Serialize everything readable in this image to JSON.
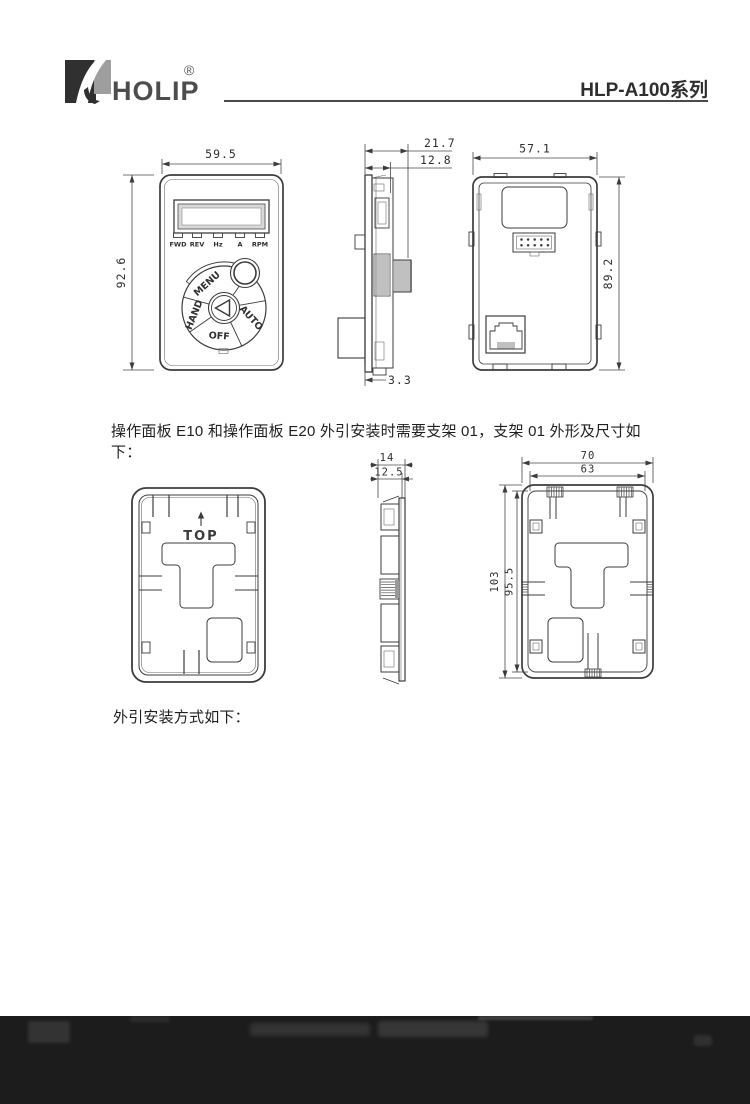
{
  "header": {
    "logo_text": "HOLIP",
    "registered_mark": "®",
    "series_title": "HLP-A100系列"
  },
  "paragraphs": {
    "bracket_note": "操作面板 E10 和操作面板 E20 外引安装时需要支架 01，支架 01 外形及尺寸如下：",
    "mounting_note": "外引安装方式如下："
  },
  "keypad_front_view": {
    "width_mm": "59.5",
    "height_mm": "92.6",
    "led_labels": [
      "FWD",
      "REV",
      "Hz",
      "A",
      "RPM"
    ],
    "button_labels": {
      "menu": "MENU",
      "hand": "HAND",
      "off": "OFF",
      "auto": "AUTO"
    }
  },
  "keypad_side_view": {
    "total_depth_mm": "21.7",
    "body_depth_mm": "12.8",
    "tab_depth_mm": "3.3"
  },
  "keypad_back_view": {
    "width_mm": "57.1",
    "height_mm": "89.2"
  },
  "bracket_front_view": {
    "orientation_label": "TOP"
  },
  "bracket_side_view": {
    "total_depth_mm": "14",
    "inner_depth_mm": "12.5"
  },
  "bracket_back_view": {
    "outer_width_mm": "70",
    "inner_width_mm": "63",
    "outer_height_mm": "103",
    "inner_height_mm": "95.5"
  },
  "colors": {
    "line": "#3c3c3c",
    "photo_strip_background": "#1c1c1c",
    "header_rule": "#4a4a4a"
  }
}
